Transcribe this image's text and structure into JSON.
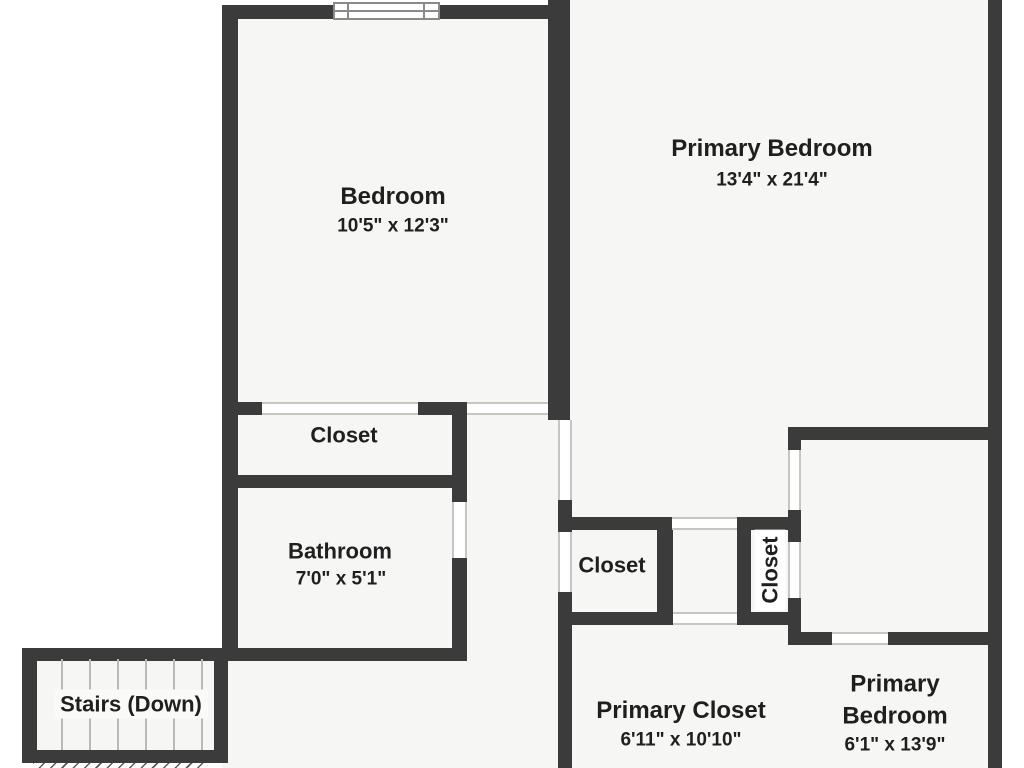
{
  "plan_title": "Upper floor plan",
  "colors": {
    "wall": "#3b3b3b",
    "floor": "#f6f6f5",
    "outside": "#ffffff",
    "text": "#1f1f1f",
    "opening_outline": "#c6c6c3",
    "window_frame": "#8a8a8a",
    "stair_tread": "#b9b9b4"
  },
  "rooms": [
    {
      "name": "Bedroom",
      "dims": "10'5\" x 12'3\""
    },
    {
      "name": "Primary Bedroom",
      "dims": "13'4\" x 21'4\""
    },
    {
      "name": "Closet"
    },
    {
      "name": "Bathroom",
      "dims": "7'0\" x 5'1\""
    },
    {
      "name": "Closet"
    },
    {
      "name": "Closet"
    },
    {
      "name": "Stairs (Down)"
    },
    {
      "name": "Primary Closet",
      "dims": "6'11\" x 10'10\""
    },
    {
      "name": "Primary\nBedroom",
      "dims": "6'1\" x 13'9\""
    }
  ],
  "geometry": {
    "rects": [
      {
        "cls": "floor",
        "name": "floor-main",
        "x": 222,
        "y": 5,
        "w": 779,
        "h": 763
      },
      {
        "cls": "floor",
        "name": "floor-primary-top",
        "x": 570,
        "y": 0,
        "w": 431,
        "h": 20
      },
      {
        "cls": "floor",
        "name": "floor-stairs",
        "x": 22,
        "y": 648,
        "w": 206,
        "h": 115
      },
      {
        "cls": "hatch",
        "name": "stairs-hatch",
        "x": 33,
        "y": 761,
        "w": 174,
        "h": 7
      },
      {
        "cls": "wall",
        "name": "wall-bedroom-top",
        "x": 222,
        "y": 5,
        "w": 348,
        "h": 14
      },
      {
        "cls": "wall",
        "name": "wall-left-outer",
        "x": 222,
        "y": 5,
        "w": 16,
        "h": 656
      },
      {
        "cls": "wall",
        "name": "wall-bedroom-primary-divider",
        "x": 548,
        "y": 0,
        "w": 22,
        "h": 420
      },
      {
        "cls": "wall",
        "name": "wall-right-outer",
        "x": 988,
        "y": 0,
        "w": 14,
        "h": 768
      },
      {
        "cls": "wall",
        "name": "wall-bedroom-bottom-left",
        "x": 222,
        "y": 402,
        "w": 40,
        "h": 13
      },
      {
        "cls": "wall",
        "name": "wall-bedroom-bottom-mid",
        "x": 418,
        "y": 402,
        "w": 49,
        "h": 13
      },
      {
        "cls": "wall",
        "name": "wall-hall-west-upper",
        "x": 452,
        "y": 402,
        "w": 15,
        "h": 100
      },
      {
        "cls": "wall",
        "name": "wall-hall-west-lower",
        "x": 452,
        "y": 558,
        "w": 15,
        "h": 103
      },
      {
        "cls": "wall",
        "name": "wall-closet-bathroom-divider",
        "x": 222,
        "y": 475,
        "w": 245,
        "h": 13
      },
      {
        "cls": "wall",
        "name": "wall-bathroom-stairs-top",
        "x": 22,
        "y": 648,
        "w": 441,
        "h": 13
      },
      {
        "cls": "wall",
        "name": "wall-stairs-left",
        "x": 22,
        "y": 648,
        "w": 15,
        "h": 115
      },
      {
        "cls": "wall",
        "name": "wall-stairs-bottom",
        "x": 22,
        "y": 750,
        "w": 206,
        "h": 13
      },
      {
        "cls": "wall",
        "name": "wall-stairs-right",
        "x": 214,
        "y": 648,
        "w": 14,
        "h": 115
      },
      {
        "cls": "wall",
        "name": "wall-hall-east-a",
        "x": 558,
        "y": 500,
        "w": 14,
        "h": 32
      },
      {
        "cls": "wall",
        "name": "wall-hall-east-b",
        "x": 558,
        "y": 592,
        "w": 14,
        "h": 176
      },
      {
        "cls": "wall",
        "name": "wall-primary-bottom-left",
        "x": 558,
        "y": 517,
        "w": 114,
        "h": 13
      },
      {
        "cls": "wall",
        "name": "wall-primary-bottom-right",
        "x": 737,
        "y": 517,
        "w": 64,
        "h": 13
      },
      {
        "cls": "wall",
        "name": "wall-midcloset-right",
        "x": 657,
        "y": 517,
        "w": 16,
        "h": 108
      },
      {
        "cls": "wall",
        "name": "wall-midcloset-bottom",
        "x": 558,
        "y": 612,
        "w": 115,
        "h": 13
      },
      {
        "cls": "wall",
        "name": "wall-vcloset-left",
        "x": 737,
        "y": 517,
        "w": 14,
        "h": 108
      },
      {
        "cls": "wall",
        "name": "wall-vcloset-bottom",
        "x": 737,
        "y": 612,
        "w": 64,
        "h": 13
      },
      {
        "cls": "wall",
        "name": "wall-east-vertical-a",
        "x": 788,
        "y": 427,
        "w": 13,
        "h": 23
      },
      {
        "cls": "wall",
        "name": "wall-east-vertical-b",
        "x": 788,
        "y": 510,
        "w": 13,
        "h": 32
      },
      {
        "cls": "wall",
        "name": "wall-east-vertical-c",
        "x": 788,
        "y": 598,
        "w": 13,
        "h": 47
      },
      {
        "cls": "wall",
        "name": "wall-upper-right-horizontal",
        "x": 788,
        "y": 427,
        "w": 213,
        "h": 13
      },
      {
        "cls": "wall",
        "name": "wall-lower-right-stub",
        "x": 788,
        "y": 632,
        "w": 44,
        "h": 13
      },
      {
        "cls": "wall",
        "name": "wall-lower-right-horizontal",
        "x": 888,
        "y": 632,
        "w": 113,
        "h": 13
      },
      {
        "cls": "opening-h",
        "name": "opening-bedroom-closet",
        "x": 262,
        "y": 402,
        "w": 156,
        "h": 13
      },
      {
        "cls": "opening-h",
        "name": "opening-bedroom-door",
        "x": 467,
        "y": 402,
        "w": 81,
        "h": 13
      },
      {
        "cls": "opening-v",
        "name": "opening-primary-door",
        "x": 558,
        "y": 420,
        "w": 14,
        "h": 80
      },
      {
        "cls": "opening-v",
        "name": "opening-bathroom-door",
        "x": 452,
        "y": 502,
        "w": 15,
        "h": 56
      },
      {
        "cls": "opening-v",
        "name": "opening-midcloset-door",
        "x": 558,
        "y": 532,
        "w": 14,
        "h": 60
      },
      {
        "cls": "opening-h",
        "name": "opening-primary-bottom",
        "x": 672,
        "y": 517,
        "w": 65,
        "h": 13
      },
      {
        "cls": "opening-v",
        "name": "opening-bedroom2-door",
        "x": 788,
        "y": 450,
        "w": 13,
        "h": 60
      },
      {
        "cls": "opening-v",
        "name": "opening-vcloset-door",
        "x": 788,
        "y": 542,
        "w": 13,
        "h": 56
      },
      {
        "cls": "opening-h",
        "name": "opening-bedroom2-south-door",
        "x": 832,
        "y": 632,
        "w": 56,
        "h": 13
      },
      {
        "cls": "opening-h",
        "name": "opening-primary-closet-entry",
        "x": 673,
        "y": 612,
        "w": 64,
        "h": 13
      },
      {
        "cls": "winframe",
        "name": "window-frame",
        "x": 333,
        "y": 2,
        "w": 107,
        "h": 18
      },
      {
        "cls": "winline-v",
        "name": "window-jamb-left",
        "x": 347,
        "y": 3,
        "w": 2,
        "h": 16
      },
      {
        "cls": "winline-v",
        "name": "window-jamb-right",
        "x": 423,
        "y": 3,
        "w": 2,
        "h": 16
      },
      {
        "cls": "winline-h",
        "name": "window-mid-line",
        "x": 335,
        "y": 10,
        "w": 103,
        "h": 2
      },
      {
        "cls": "tread",
        "name": "stair-tread",
        "x": 61,
        "y": 659,
        "w": 2,
        "h": 91
      },
      {
        "cls": "tread",
        "name": "stair-tread",
        "x": 89,
        "y": 659,
        "w": 2,
        "h": 91
      },
      {
        "cls": "tread",
        "name": "stair-tread",
        "x": 117,
        "y": 659,
        "w": 2,
        "h": 91
      },
      {
        "cls": "tread",
        "name": "stair-tread",
        "x": 145,
        "y": 659,
        "w": 2,
        "h": 91
      },
      {
        "cls": "tread",
        "name": "stair-tread",
        "x": 173,
        "y": 659,
        "w": 2,
        "h": 91
      },
      {
        "cls": "tread",
        "name": "stair-tread",
        "x": 201,
        "y": 659,
        "w": 2,
        "h": 91
      }
    ]
  }
}
